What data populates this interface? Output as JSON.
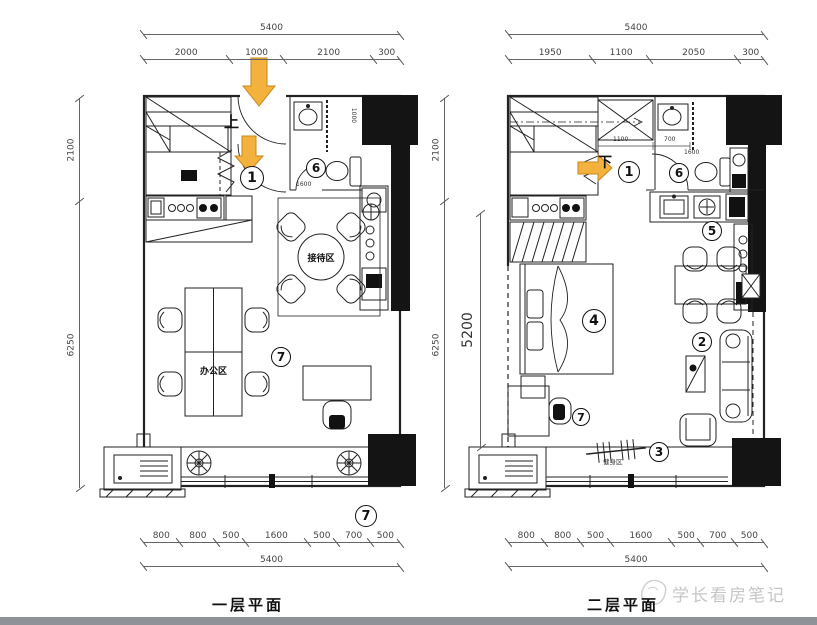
{
  "colors": {
    "arrow": "#F2B23D",
    "arrow_edge": "#C9861C",
    "wall": "#141414",
    "watermark": "#C6C6C6",
    "footer_bar": "#8F9297"
  },
  "watermark": {
    "text": "学长看房笔记"
  },
  "plan1": {
    "title": "一层平面",
    "stair_direction": "上",
    "rooms": {
      "reception": "接待区",
      "office": "办公区"
    },
    "markers": {
      "entry": "1",
      "toilet": "6",
      "office": "7",
      "balcony": "7"
    },
    "inner_dims": {
      "bath_width": "1600",
      "bath_depth": "1000"
    },
    "dims": {
      "top_total": [
        "5400"
      ],
      "top_segments": [
        "2000",
        "1000",
        "2100",
        "300"
      ],
      "left_segments": [
        "2100",
        "6250"
      ],
      "bottom_segments": [
        "800",
        "800",
        "500",
        "1600",
        "500",
        "700",
        "500"
      ],
      "bottom_total": [
        "5400"
      ]
    }
  },
  "plan2": {
    "title": "二层平面",
    "stair_direction": "下",
    "rooms": {
      "fitness": "健身区"
    },
    "markers": {
      "entry": "1",
      "sofa": "2",
      "fitness": "3",
      "bed": "4",
      "kitchen": "5",
      "toilet": "6",
      "desk": "7"
    },
    "inner_dims": {
      "stair_width": "1100",
      "bath_sink": "700",
      "bath_width": "1600"
    },
    "dims": {
      "top_total": [
        "5400"
      ],
      "top_segments": [
        "1950",
        "1100",
        "2050",
        "300"
      ],
      "left_segments": [
        "2100",
        "6250"
      ],
      "inner_height": [
        "5200"
      ],
      "bottom_segments": [
        "800",
        "800",
        "500",
        "1600",
        "500",
        "700",
        "500"
      ],
      "bottom_total": [
        "5400"
      ]
    }
  }
}
